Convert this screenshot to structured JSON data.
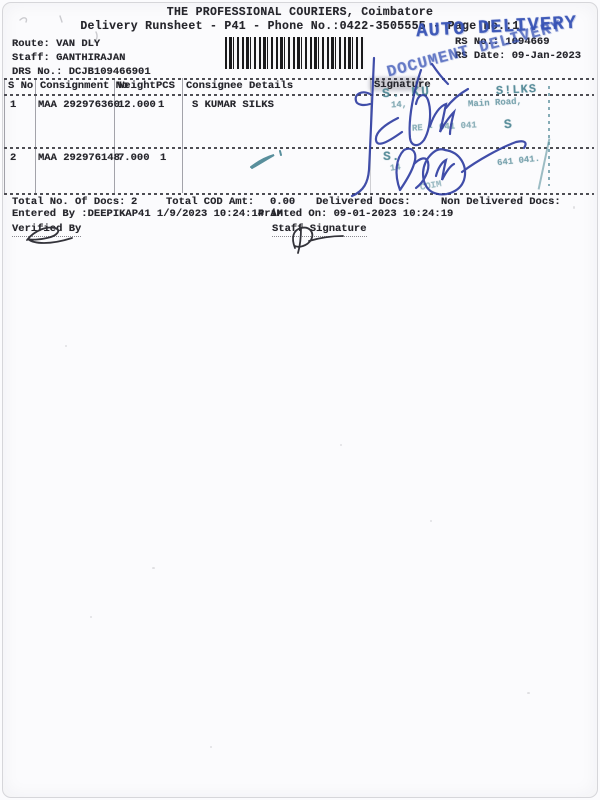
{
  "header": {
    "title": "THE PROFESSIONAL COURIERS, Coimbatore",
    "subtitle": "Delivery Runsheet - P41 - Phone No.:0422-3505555 - Page No.:1"
  },
  "info": {
    "route_label": "Route:",
    "route_value": "VAN DLY",
    "staff_label": "Staff:",
    "staff_value": "GANTHIRAJAN",
    "drs_label": "DRS No.:",
    "drs_value": "DCJB109466901",
    "rs_no_label": "RS No.:",
    "rs_no_value": "1094669",
    "rs_date_label": "RS Date:",
    "rs_date_value": "09-Jan-2023"
  },
  "stamps": {
    "auto_delivery": "AUTO DELIVERY",
    "document_delivery": "DOCUMENT DELIVERY",
    "ink_blue": "#3450b4",
    "ink_teal": "#4e8694",
    "row1": {
      "name_left": "S. KU",
      "name_right": "S!LKS",
      "addr_left": "14,",
      "addr_right": "Main Road,",
      "city_fragment": "RE - 641 041",
      "suffix": "S"
    },
    "row2": {
      "initial": "S.",
      "number": "14",
      "pincode": "641 041.",
      "city_partial": "COIM"
    }
  },
  "table": {
    "headers": {
      "s_no": "S No",
      "consignment_no": "Consignment No",
      "weight": "Weight",
      "pcs": "PCS",
      "consignee": "Consignee Details",
      "signature": "Signature"
    },
    "rows": [
      {
        "s_no": "1",
        "consignment_no": "MAA 292976360",
        "weight": "12.000",
        "pcs": "1",
        "consignee": "S KUMAR SILKS"
      },
      {
        "s_no": "2",
        "consignment_no": "MAA 292976148",
        "weight": "7.000",
        "pcs": "1",
        "consignee": ""
      }
    ]
  },
  "summary": {
    "total_docs_label": "Total No. Of Docs:",
    "total_docs_value": "2",
    "total_cod_label": "Total COD Amt:",
    "total_cod_value": "0.00",
    "delivered_label": "Delivered Docs:",
    "non_delivered_label": "Non Delivered Docs:",
    "entered_by": "Entered By :DEEPIKAP41 1/9/2023 10:24:14 AM",
    "printed_on": "Printed On: 09-01-2023 10:24:19"
  },
  "footer": {
    "verified_by_label": "Verified By",
    "staff_signature_label": "Staff Signature"
  }
}
